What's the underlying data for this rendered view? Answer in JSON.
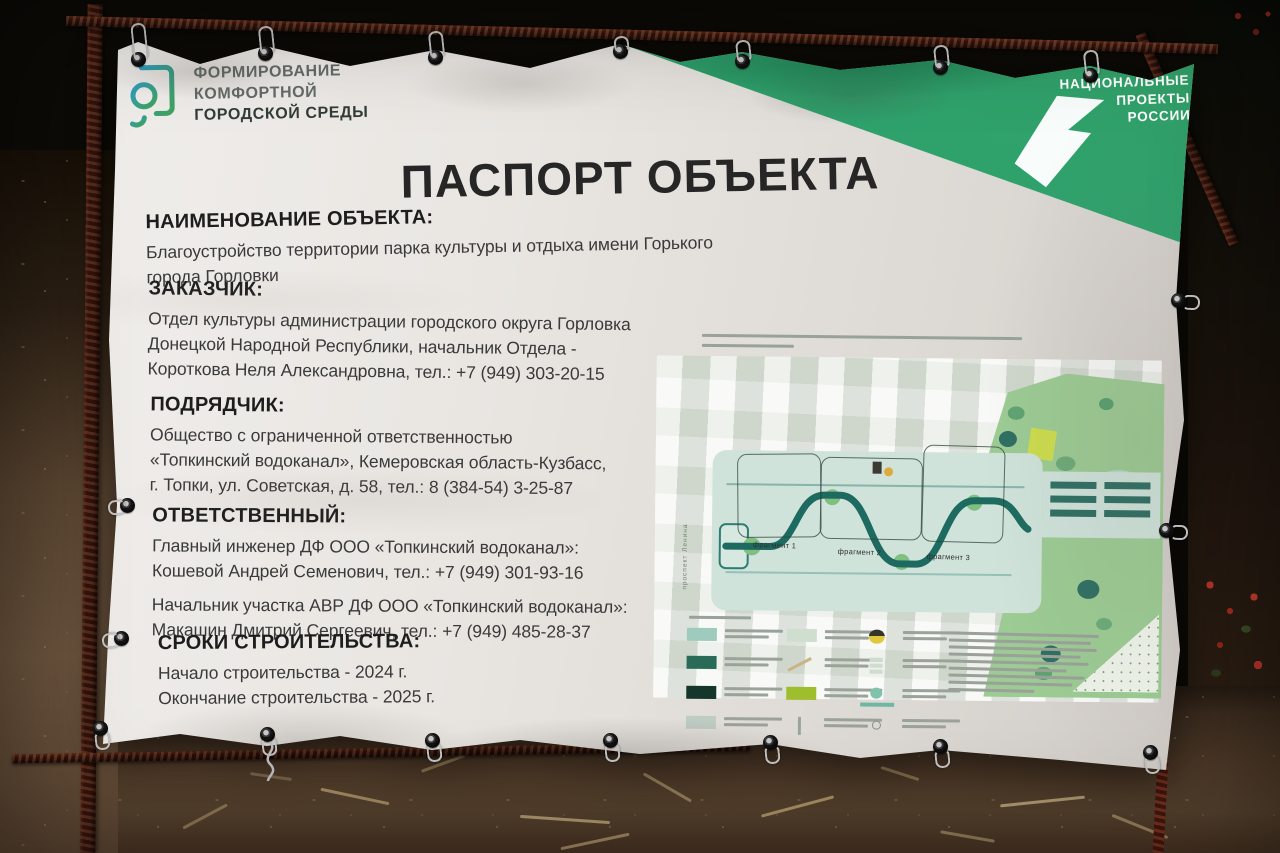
{
  "banner": {
    "program_logo": {
      "line1": "ФОРМИРОВАНИЕ",
      "line2": "КОМФОРТНОЙ",
      "line3": "ГОРОДСКОЙ СРЕДЫ"
    },
    "national_projects": {
      "line1": "НАЦИОНАЛЬНЫЕ",
      "line2": "ПРОЕКТЫ",
      "line3": "РОССИИ"
    },
    "title": "ПАСПОРТ ОБЪЕКТА",
    "sections": [
      {
        "heading": "НАИМЕНОВАНИЕ ОБЪЕКТА:",
        "lines": [
          "Благоустройство территории парка культуры и отдыха имени Горького города Горловки"
        ]
      },
      {
        "heading": "ЗАКАЗЧИК:",
        "lines": [
          "Отдел культуры администрации городского округа Горловка",
          "Донецкой Народной Республики, начальник Отдела -",
          "Короткова Неля Александровна, тел.: +7 (949) 303-20-15"
        ]
      },
      {
        "heading": "ПОДРЯДЧИК:",
        "lines": [
          "Общество с ограниченной ответственностью",
          "«Топкинский водоканал», Кемеровская область-Кузбасс,",
          "г. Топки, ул. Советская, д. 58, тел.: 8 (384-54) 3-25-87"
        ]
      },
      {
        "heading": "ОТВЕТСТВЕННЫЙ:",
        "lines": [
          "Главный инженер ДФ ООО «Топкинский водоканал»:",
          "Кошевой Андрей Семенович, тел.: +7 (949) 301-93-16",
          "Начальник участка АВР ДФ ООО «Топкинский водоканал»:",
          "Макашин Дмитрий Сергеевич, тел.: +7 (949) 485-28-37"
        ]
      },
      {
        "heading": "СРОКИ СТРОИТЕЛЬСТВА:",
        "lines": [
          "Начало строительства - 2024 г.",
          "Окончание строительства - 2025 г."
        ]
      }
    ],
    "site_plan": {
      "fragment_labels": [
        "фрагмент 1",
        "фрагмент 2",
        "фрагмент 3"
      ],
      "street_label": "проспект Ленина",
      "legend_columns": [
        {
          "items": [
            {
              "t": "swatch",
              "c": "#9ecbbd"
            },
            {
              "t": "swatch",
              "c": "#2a6b57"
            },
            {
              "t": "swatch",
              "c": "#16352b"
            },
            {
              "t": "swatch",
              "c": "#bfccc3"
            }
          ]
        },
        {
          "items": [
            {
              "t": "swatch",
              "c": "#cfdecf"
            },
            {
              "t": "diag",
              "c": "#c9b483"
            },
            {
              "t": "swatch",
              "c": "#9fbe2e"
            },
            {
              "t": "vline",
              "c": "#9aa59c"
            }
          ]
        },
        {
          "items": [
            {
              "t": "fountain",
              "c": "#e0c83c"
            },
            {
              "t": "stack",
              "c": "#cfdccf"
            },
            {
              "t": "pond",
              "c": "#7fc3ad"
            },
            {
              "t": "dot",
              "c": "#8a948c"
            }
          ]
        }
      ]
    },
    "colors": {
      "banner_white": "#e9e6e2",
      "accent_green": "#32a068",
      "accent_teal": "#1ba795",
      "accent_blue": "#2f8fc0",
      "logo_teal": "#2d9fc0",
      "logo_green": "#41a25c",
      "rebar_rust": "#5e2f1f",
      "text_dark": "#2b2b2b"
    }
  }
}
